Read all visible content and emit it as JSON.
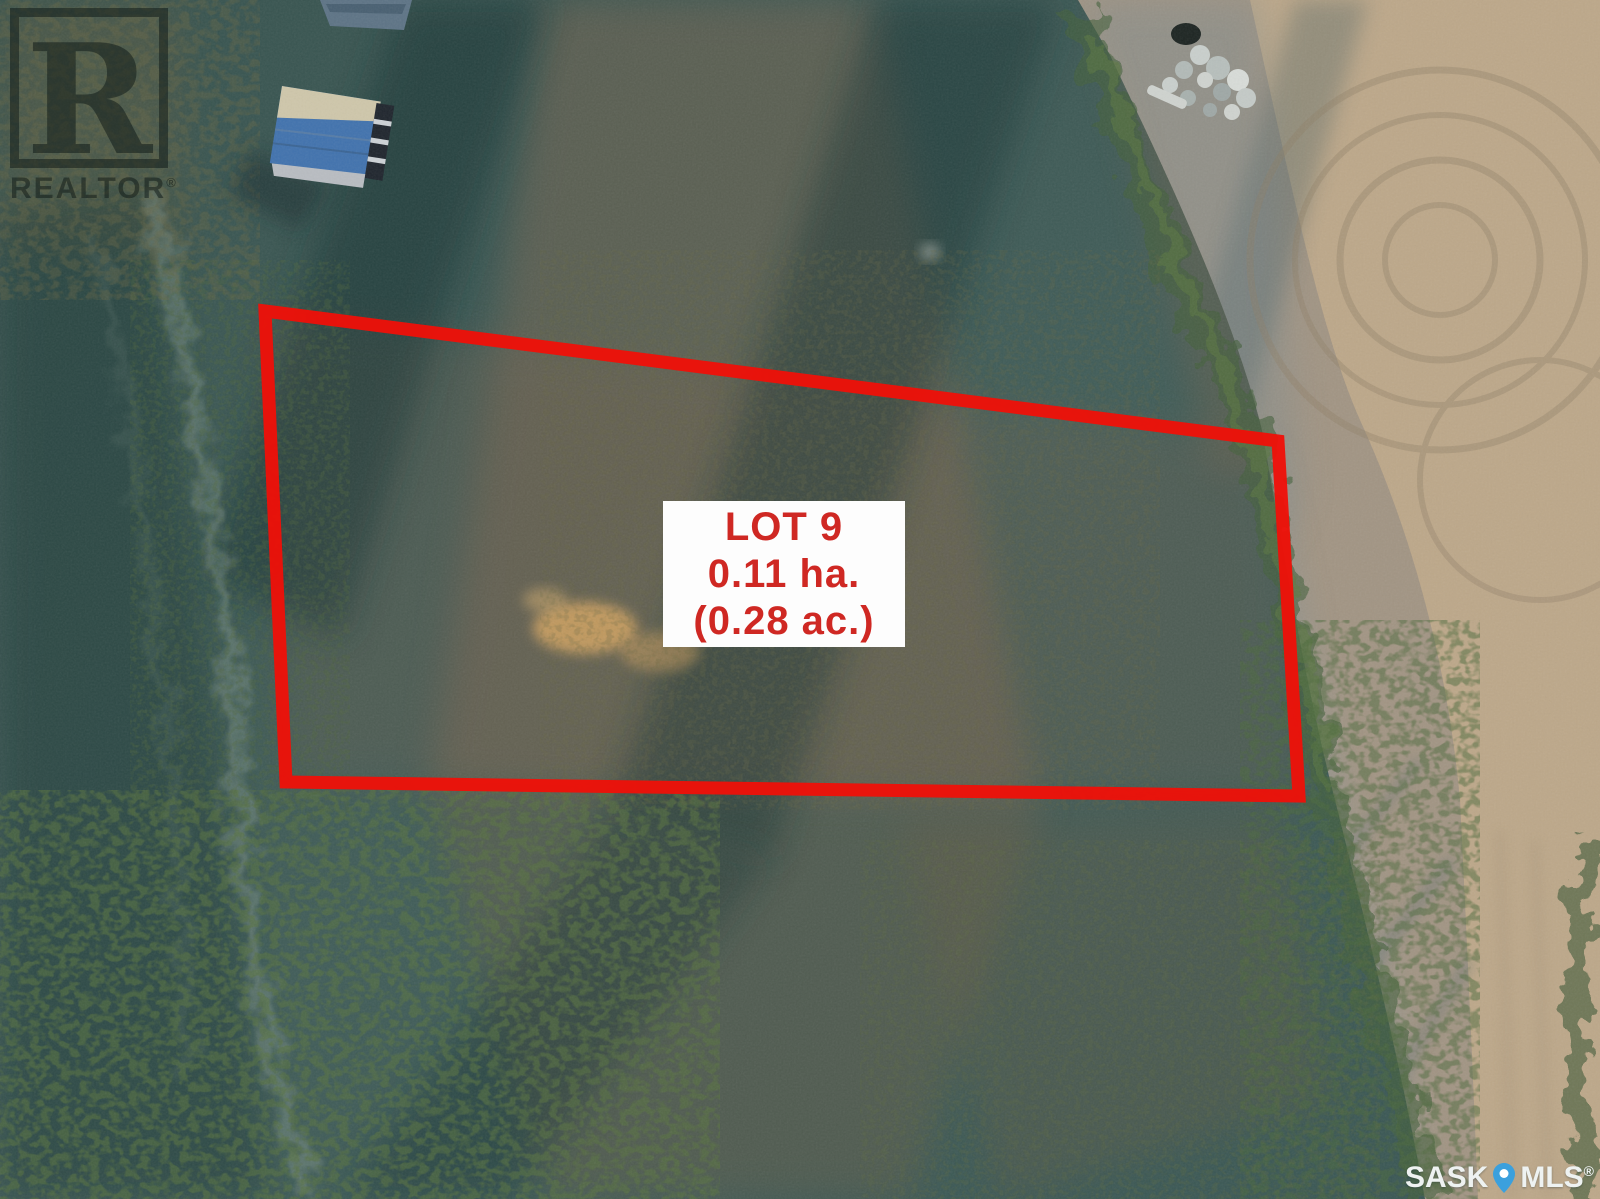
{
  "image": {
    "kind": "aerial-drone-photo",
    "width_px": 1600,
    "height_px": 1199
  },
  "lot": {
    "label_line1": "LOT 9",
    "label_line2": "0.11 ha.",
    "label_line3": "(0.28 ac.)",
    "polygon_points": "265,311 1278,441 1299,796 286,782",
    "outline_color": "#f01008",
    "label_text_color": "#cf2823",
    "label_bg_color": "#fdfdfd"
  },
  "watermarks": {
    "realtor": {
      "logo_letter": "R",
      "text": "REALTOR",
      "registered": "®"
    },
    "mls": {
      "left": "SASK",
      "right": "MLS",
      "registered": "®",
      "pin_color": "#3ba0dd",
      "text_color": "#eef2f1"
    }
  }
}
